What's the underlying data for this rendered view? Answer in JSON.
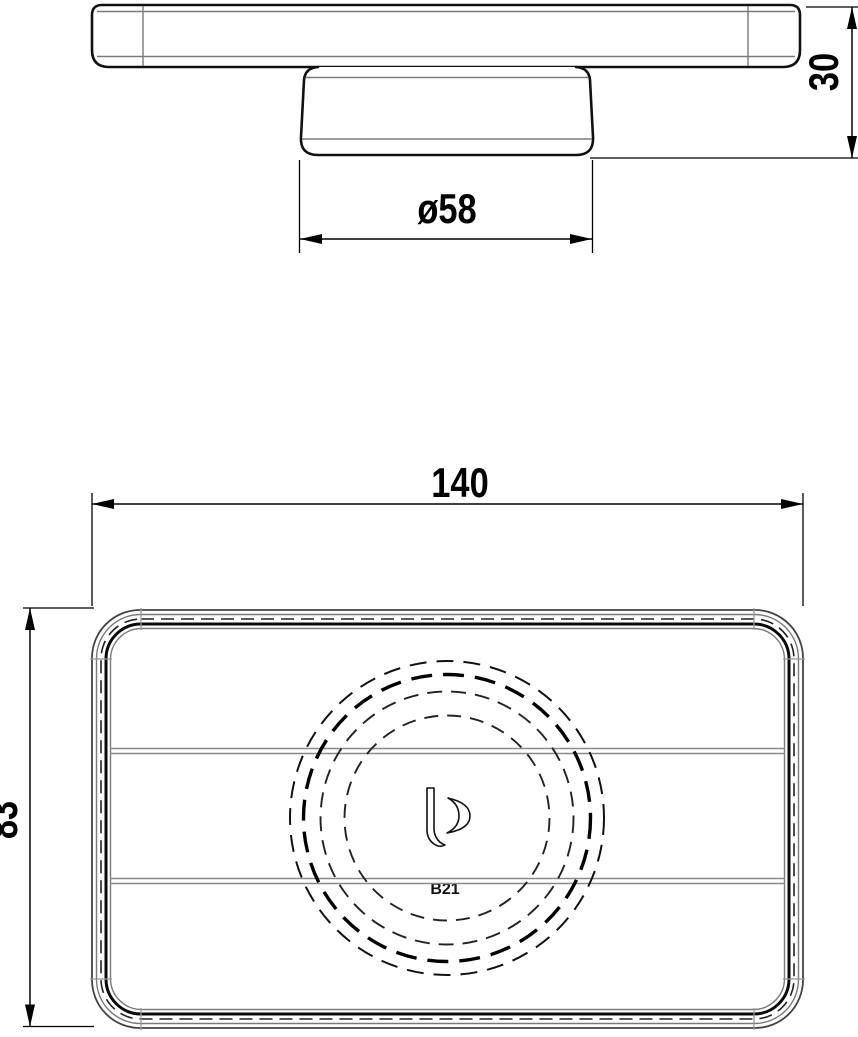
{
  "dims": {
    "cup_diameter": "ø58",
    "height": "30",
    "width": "140",
    "depth": "83"
  },
  "labels": {
    "stamp": "B21"
  },
  "colors": {
    "outline_bold": "#111111",
    "outline_medium": "#444444",
    "line_thin": "#7a7a7a",
    "dimension": "#000000",
    "background": "#ffffff"
  }
}
